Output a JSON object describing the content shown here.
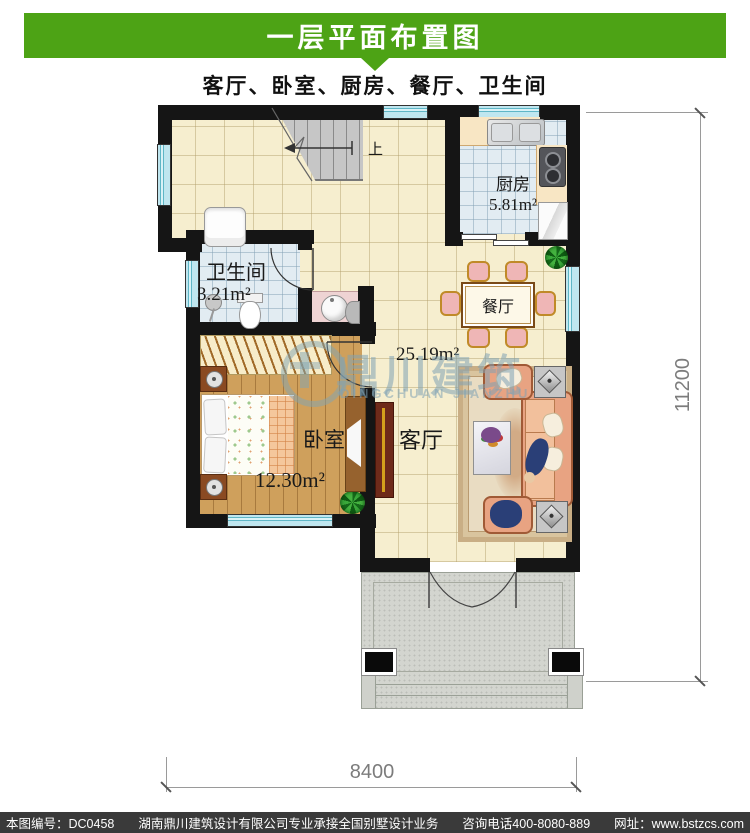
{
  "header": {
    "title": "一层平面布置图",
    "subtitle": "客厅、卧室、厨房、餐厅、卫生间"
  },
  "rooms": {
    "kitchen": {
      "name": "厨房",
      "area": "5.81m²"
    },
    "dining": {
      "name": "餐厅"
    },
    "bathroom": {
      "name": "卫生间",
      "area": "3.21m²"
    },
    "bedroom": {
      "name": "卧室",
      "area": "12.30m²"
    },
    "living": {
      "name": "客厅",
      "area": "25.19m²"
    }
  },
  "stairs": {
    "up_label": "上"
  },
  "dimensions": {
    "width": "8400",
    "height": "11200"
  },
  "watermark": {
    "cn": "鼎川建筑",
    "en": "DINGCHUAN JIANZHU"
  },
  "footer": {
    "plan_no": "本图编号：DC0458",
    "company": "湖南鼎川建筑设计有限公司专业承接全国别墅设计业务",
    "phone": "咨询电话400-8080-889",
    "web": "网址：www.bstzcs.com"
  },
  "colors": {
    "header_green": "#4da315",
    "wall_black": "#151515",
    "floor_cream": "#f6eecf",
    "tile_blue": "#e2ecf2",
    "wood": "#cfa05c",
    "window_cyan": "#bfe6ef",
    "porch_gray": "#d3d5cf",
    "footer_gray": "#3a3a3a"
  }
}
